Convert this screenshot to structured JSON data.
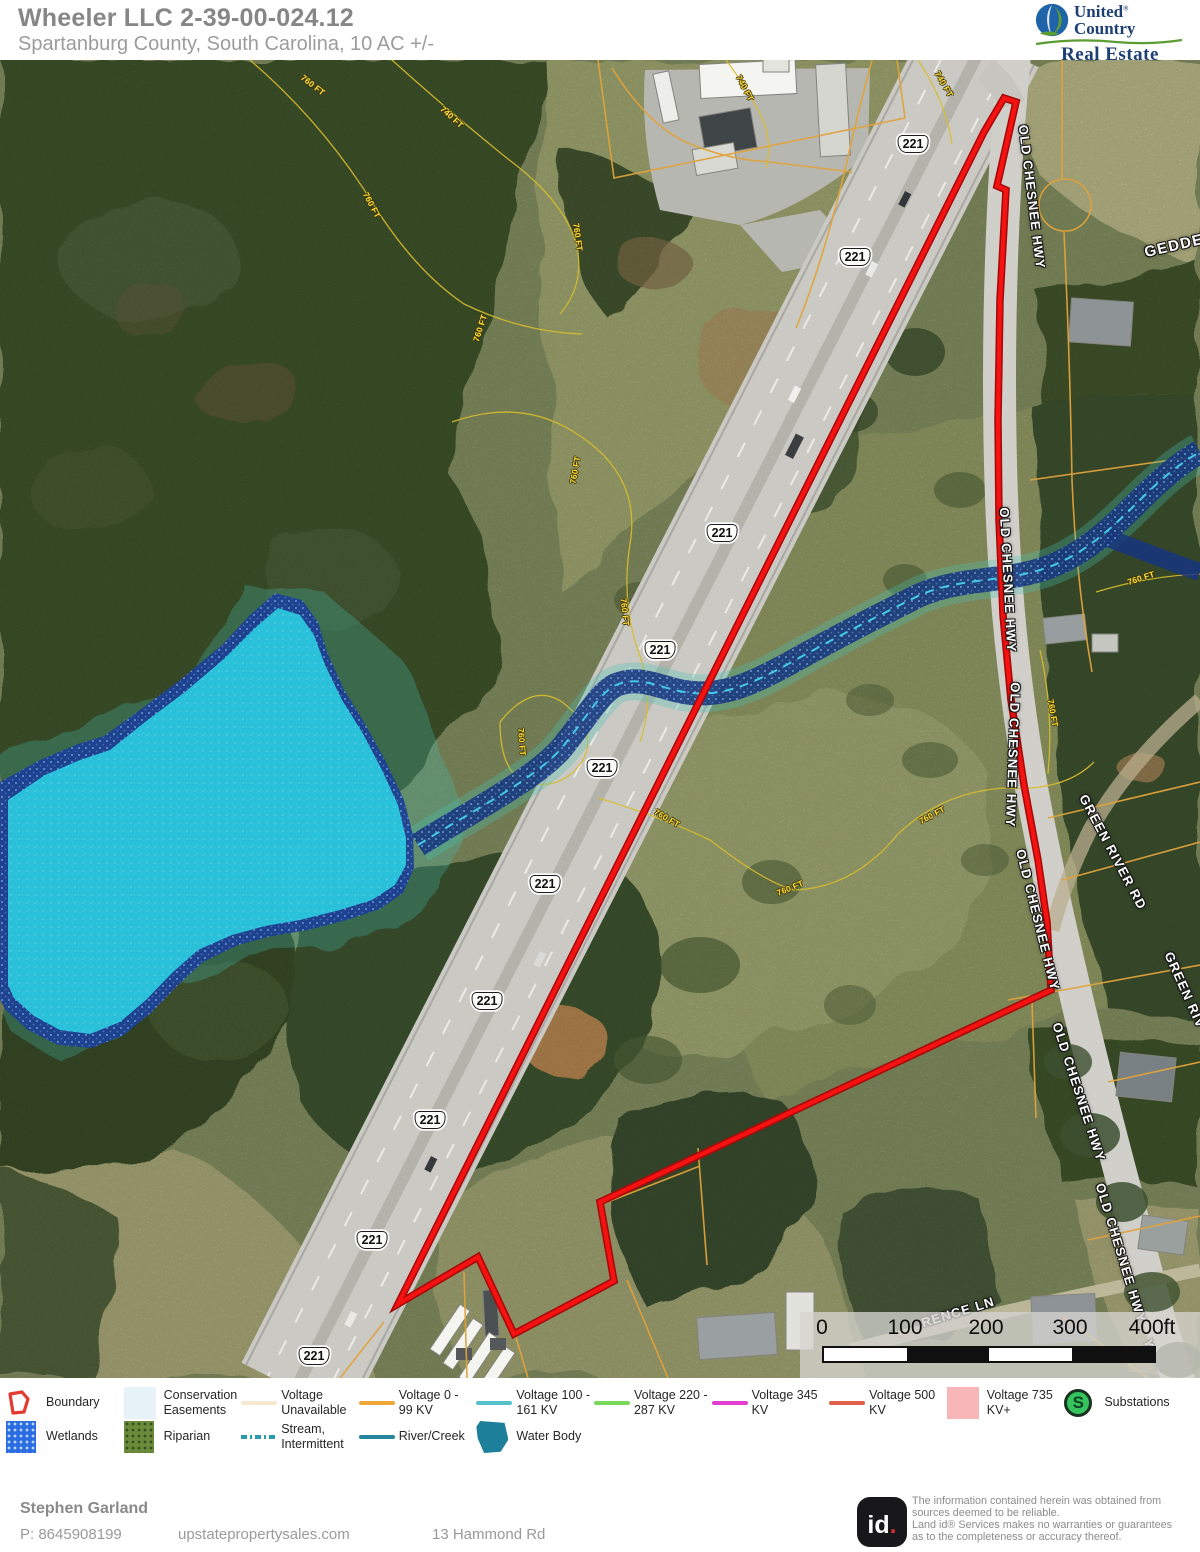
{
  "header": {
    "title": "Wheeler LLC 2-39-00-024.12",
    "subtitle": "Spartanburg County, South Carolina, 10 AC +/-"
  },
  "logo": {
    "united": "United",
    "reg": "®",
    "country": "Country",
    "real_estate": "Real Estate"
  },
  "map": {
    "route_shield": "221",
    "shields": [
      [
        913,
        84
      ],
      [
        855,
        197
      ],
      [
        722,
        473
      ],
      [
        660,
        590
      ],
      [
        602,
        708
      ],
      [
        545,
        824
      ],
      [
        487,
        941
      ],
      [
        430,
        1060
      ],
      [
        372,
        1180
      ],
      [
        314,
        1296
      ]
    ],
    "road_labels": [
      {
        "text": "OLD CHESNEE HWY",
        "x": 1032,
        "y": 137,
        "rot": 83
      },
      {
        "text": "OLD CHESNEE HWY",
        "x": 1008,
        "y": 520,
        "rot": 87
      },
      {
        "text": "OLD CHESNEE HWY",
        "x": 1013,
        "y": 695,
        "rot": 92
      },
      {
        "text": "OLD CHESNEE HWY",
        "x": 1038,
        "y": 860,
        "rot": 76
      },
      {
        "text": "OLD CHESNEE HWY",
        "x": 1079,
        "y": 1032,
        "rot": 72
      },
      {
        "text": "OLD CHESNEE HWY",
        "x": 1121,
        "y": 1193,
        "rot": 73
      },
      {
        "text": "GREEN RIVER RD",
        "x": 1113,
        "y": 792,
        "rot": 62
      },
      {
        "text": "GREEN RIV",
        "x": 1185,
        "y": 930,
        "rot": 66
      },
      {
        "text": "GEDDE",
        "x": 1174,
        "y": 186,
        "rot": -13,
        "size": 15
      },
      {
        "text": "RENCE LN",
        "x": 958,
        "y": 1252,
        "rot": -17
      },
      {
        "text": "Y",
        "x": 1149,
        "y": 1284,
        "rot": 75
      }
    ],
    "contour_labels": [
      {
        "text": "760 FT",
        "x": 313,
        "y": 25,
        "rot": 38
      },
      {
        "text": "740 FT",
        "x": 452,
        "y": 57,
        "rot": 42
      },
      {
        "text": "760 FT",
        "x": 372,
        "y": 145,
        "rot": 62
      },
      {
        "text": "740 FT",
        "x": 944,
        "y": 24,
        "rot": 60
      },
      {
        "text": "740 FT",
        "x": 745,
        "y": 28,
        "rot": 62
      },
      {
        "text": "760 FT",
        "x": 578,
        "y": 177,
        "rot": 82
      },
      {
        "text": "760 FT",
        "x": 480,
        "y": 268,
        "rot": -72
      },
      {
        "text": "760 FT",
        "x": 575,
        "y": 410,
        "rot": -80
      },
      {
        "text": "760 FT",
        "x": 625,
        "y": 552,
        "rot": 84
      },
      {
        "text": "760 FT",
        "x": 522,
        "y": 682,
        "rot": 86
      },
      {
        "text": "760 FT",
        "x": 667,
        "y": 758,
        "rot": 30
      },
      {
        "text": "760 FT",
        "x": 790,
        "y": 828,
        "rot": -22
      },
      {
        "text": "760 FT",
        "x": 932,
        "y": 755,
        "rot": -28
      },
      {
        "text": "760 FT",
        "x": 1053,
        "y": 653,
        "rot": 80
      },
      {
        "text": "760 FT",
        "x": 1141,
        "y": 518,
        "rot": -18
      }
    ],
    "scalebar": {
      "ticks": [
        {
          "label": "0",
          "x": 22
        },
        {
          "label": "100",
          "x": 105
        },
        {
          "label": "200",
          "x": 186
        },
        {
          "label": "300",
          "x": 270
        },
        {
          "label": "400ft",
          "x": 352
        }
      ]
    }
  },
  "legend": {
    "rows": [
      [
        {
          "label": "Boundary",
          "type": "boundary",
          "color": "#e23b30"
        },
        {
          "label": "Conservation Easements",
          "type": "swatch",
          "color": "#e7f3f8"
        },
        {
          "label": "Voltage Unavailable",
          "type": "line",
          "color": "#f6e9d0"
        },
        {
          "label": "Voltage 0 - 99 KV",
          "type": "line",
          "color": "#f0a73a"
        },
        {
          "label": "Voltage 100 - 161 KV",
          "type": "line",
          "color": "#57c0cb"
        },
        {
          "label": "Voltage 220 - 287 KV",
          "type": "line",
          "color": "#77d957"
        },
        {
          "label": "Voltage 345 KV",
          "type": "line",
          "color": "#e23ed0"
        },
        {
          "label": "Voltage 500 KV",
          "type": "line",
          "color": "#e0604a"
        },
        {
          "label": "Voltage 735 KV+",
          "type": "swatch",
          "color": "#f9b6b6"
        },
        {
          "label": "Substations",
          "type": "substation",
          "color": "#35c45e",
          "letter": "S"
        }
      ],
      [
        {
          "label": "Wetlands",
          "type": "dots",
          "color": "#2b6de0",
          "dot": "#bcd6ff"
        },
        {
          "label": "Riparian",
          "type": "dots",
          "color": "#6b8a3a",
          "dot": "#33511d"
        },
        {
          "label": "Stream, Intermittent",
          "type": "dashline",
          "color": "#2a9ab0"
        },
        {
          "label": "River/Creek",
          "type": "line",
          "color": "#25859c"
        },
        {
          "label": "Water Body",
          "type": "waterbody",
          "color": "#1d7f99"
        }
      ]
    ]
  },
  "footer": {
    "agent": "Stephen Garland",
    "phone": "P: 8645908199",
    "website": "upstatepropertysales.com",
    "address": "13 Hammond Rd",
    "badge_id": "id",
    "badge_dot": ".",
    "disclaimer_lines": [
      "The information contained herein was obtained from",
      "sources deemed to be reliable.",
      "Land id® Services makes no warranties or guarantees",
      "as to the completeness or accuracy thereof."
    ]
  }
}
